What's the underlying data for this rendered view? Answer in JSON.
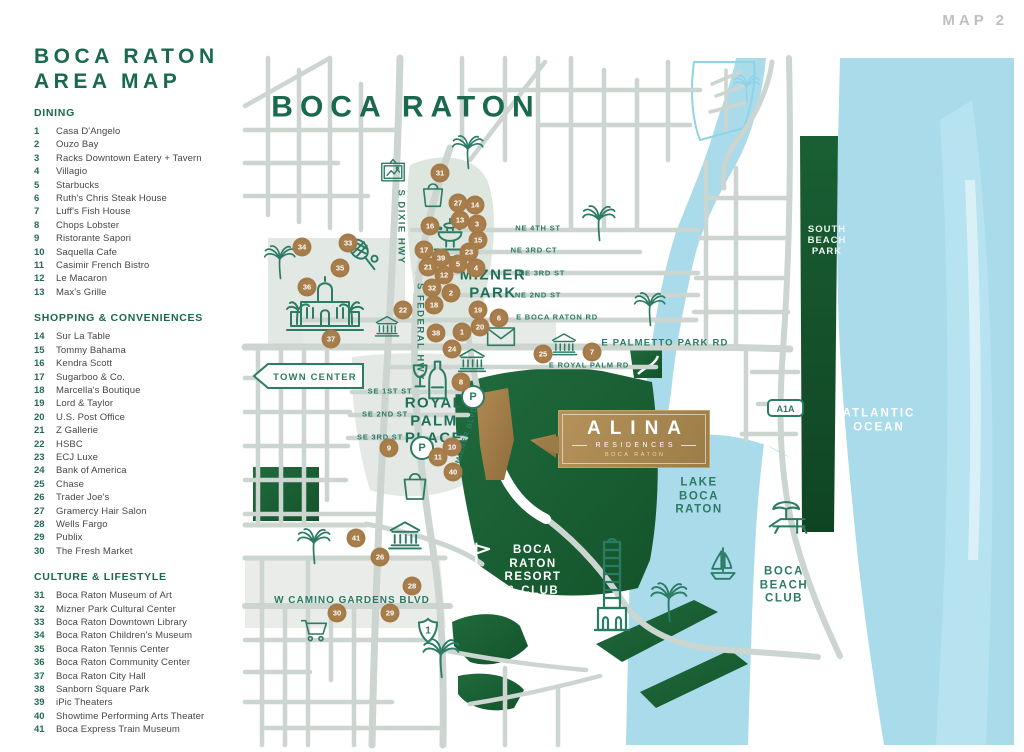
{
  "header": {
    "map_tag": "MAP 2"
  },
  "sidebar": {
    "title": "BOCA RATON\nAREA MAP",
    "sections": [
      {
        "title": "DINING",
        "items": [
          [
            "1",
            "Casa D'Angelo"
          ],
          [
            "2",
            "Ouzo Bay"
          ],
          [
            "3",
            "Racks Downtown Eatery + Tavern"
          ],
          [
            "4",
            "Villagio"
          ],
          [
            "5",
            "Starbucks"
          ],
          [
            "6",
            "Ruth's Chris Steak House"
          ],
          [
            "7",
            "Luff's Fish House"
          ],
          [
            "8",
            "Chops Lobster"
          ],
          [
            "9",
            "Ristorante Sapori"
          ],
          [
            "10",
            "Saquella Cafe"
          ],
          [
            "11",
            "Casimir French Bistro"
          ],
          [
            "12",
            "Le Macaron"
          ],
          [
            "13",
            "Max's Grille"
          ]
        ]
      },
      {
        "title": "SHOPPING & CONVENIENCES",
        "items": [
          [
            "14",
            "Sur La Table"
          ],
          [
            "15",
            "Tommy Bahama"
          ],
          [
            "16",
            "Kendra Scott"
          ],
          [
            "17",
            "Sugarboo & Co."
          ],
          [
            "18",
            "Marcella's Boutique"
          ],
          [
            "19",
            "Lord & Taylor"
          ],
          [
            "20",
            "U.S. Post Office"
          ],
          [
            "21",
            "Z Gallerie"
          ],
          [
            "22",
            "HSBC"
          ],
          [
            "23",
            "ECJ Luxe"
          ],
          [
            "24",
            "Bank of America"
          ],
          [
            "25",
            "Chase"
          ],
          [
            "26",
            "Trader Joe's"
          ],
          [
            "27",
            "Gramercy Hair Salon"
          ],
          [
            "28",
            "Wells Fargo"
          ],
          [
            "29",
            "Publix"
          ],
          [
            "30",
            "The Fresh Market"
          ]
        ]
      },
      {
        "title": "CULTURE & LIFESTYLE",
        "items": [
          [
            "31",
            "Boca Raton Museum of Art"
          ],
          [
            "32",
            "Mizner Park Cultural Center"
          ],
          [
            "33",
            "Boca Raton Downtown Library"
          ],
          [
            "34",
            "Boca Raton Children's Museum"
          ],
          [
            "35",
            "Boca Raton Tennis Center"
          ],
          [
            "36",
            "Boca Raton Community Center"
          ],
          [
            "37",
            "Boca Raton City Hall"
          ],
          [
            "38",
            "Sanborn Square Park"
          ],
          [
            "39",
            "iPic Theaters"
          ],
          [
            "40",
            "Showtime Performing Arts Theater"
          ],
          [
            "41",
            "Boca Express Train Museum"
          ]
        ]
      }
    ]
  },
  "map": {
    "signs": {
      "town_center": "TOWN CENTER",
      "a1a": "A1A",
      "us_route": "1",
      "parking": "P"
    },
    "alina": {
      "line1": "ALINA",
      "line2": "RESIDENCES",
      "line3": "BOCA RATON"
    },
    "colors": {
      "teal": "#2c7b64",
      "dark_green_title": "#19694f",
      "marker_bronze": "#a87e4c",
      "gold": "#a98a54",
      "water": "#a9dcec",
      "park": "#1e6b3d",
      "road": "#ccd5d0"
    },
    "area_labels": [
      {
        "t": "BOCA RATON",
        "x": 406,
        "y": 107,
        "s": 30,
        "ls": 7,
        "c": "#19694f"
      },
      {
        "t": "MIZNER\nPARK",
        "x": 493,
        "y": 284,
        "s": 15,
        "ls": 1.5,
        "c": "#1f6f58"
      },
      {
        "t": "ROYAL\nPALM\nPLACE",
        "x": 434,
        "y": 421,
        "s": 15,
        "ls": 1.5,
        "c": "#1f6f58"
      },
      {
        "t": "BOCA\nRATON\nRESORT\n& CLUB",
        "x": 533,
        "y": 571,
        "s": 11.5,
        "ls": 1.5,
        "c": "#ffffff"
      },
      {
        "t": "SOUTH\nBEACH\nPARK",
        "x": 827,
        "y": 241,
        "s": 9.5,
        "ls": 1,
        "c": "#eef6f1"
      },
      {
        "t": "ATLANTIC\nOCEAN",
        "x": 879,
        "y": 421,
        "s": 11.5,
        "ls": 2,
        "c": "#ffffff"
      },
      {
        "t": "LAKE\nBOCA\nRATON",
        "x": 699,
        "y": 497,
        "s": 11.5,
        "ls": 1.5,
        "c": "#2c7b64"
      },
      {
        "t": "BOCA\nBEACH\nCLUB",
        "x": 784,
        "y": 586,
        "s": 11.5,
        "ls": 1.5,
        "c": "#2c7b64"
      }
    ],
    "street_labels": [
      {
        "t": "NE 4TH ST",
        "x": 538,
        "y": 229
      },
      {
        "t": "NE 3RD CT",
        "x": 534,
        "y": 251
      },
      {
        "t": "NE 3RD ST",
        "x": 542,
        "y": 274
      },
      {
        "t": "NE 2ND ST",
        "x": 538,
        "y": 296
      },
      {
        "t": "E BOCA RATON RD",
        "x": 557,
        "y": 318
      },
      {
        "t": "E PALMETTO PARK RD",
        "x": 665,
        "y": 343,
        "s": 9.5,
        "ls": 1.2
      },
      {
        "t": "E ROYAL PALM RD",
        "x": 589,
        "y": 366
      },
      {
        "t": "SE 1ST ST",
        "x": 390,
        "y": 392
      },
      {
        "t": "SE 2ND ST",
        "x": 385,
        "y": 415
      },
      {
        "t": "SE 3RD ST",
        "x": 380,
        "y": 438
      },
      {
        "t": "W CAMINO GARDENS BLVD",
        "x": 352,
        "y": 601,
        "s": 10,
        "ls": 1
      },
      {
        "t": "S DIXIE HWY",
        "x": 401,
        "y": 227,
        "r": 90,
        "s": 9.5,
        "ls": 1.5
      },
      {
        "t": "S FEDERAL HWY",
        "x": 420,
        "y": 332,
        "r": 90,
        "s": 9.5,
        "ls": 1.5
      },
      {
        "t": "SE MIZNER BLVD",
        "x": 465,
        "y": 442,
        "r": -73,
        "s": 7.5
      }
    ],
    "markers": [
      {
        "n": "1",
        "x": 462,
        "y": 332
      },
      {
        "n": "2",
        "x": 451,
        "y": 293
      },
      {
        "n": "3",
        "x": 477,
        "y": 224
      },
      {
        "n": "4",
        "x": 476,
        "y": 268
      },
      {
        "n": "5",
        "x": 458,
        "y": 264
      },
      {
        "n": "6",
        "x": 499,
        "y": 318
      },
      {
        "n": "7",
        "x": 592,
        "y": 352
      },
      {
        "n": "8",
        "x": 461,
        "y": 382
      },
      {
        "n": "9",
        "x": 389,
        "y": 448
      },
      {
        "n": "10",
        "x": 452,
        "y": 447
      },
      {
        "n": "11",
        "x": 438,
        "y": 457
      },
      {
        "n": "12",
        "x": 444,
        "y": 275
      },
      {
        "n": "13",
        "x": 460,
        "y": 220
      },
      {
        "n": "14",
        "x": 475,
        "y": 205
      },
      {
        "n": "15",
        "x": 478,
        "y": 240
      },
      {
        "n": "16",
        "x": 430,
        "y": 226
      },
      {
        "n": "17",
        "x": 424,
        "y": 250
      },
      {
        "n": "18",
        "x": 434,
        "y": 305
      },
      {
        "n": "19",
        "x": 478,
        "y": 310
      },
      {
        "n": "20",
        "x": 480,
        "y": 327
      },
      {
        "n": "21",
        "x": 428,
        "y": 267
      },
      {
        "n": "22",
        "x": 403,
        "y": 310
      },
      {
        "n": "23",
        "x": 469,
        "y": 252
      },
      {
        "n": "24",
        "x": 452,
        "y": 349
      },
      {
        "n": "25",
        "x": 543,
        "y": 354
      },
      {
        "n": "26",
        "x": 380,
        "y": 557
      },
      {
        "n": "27",
        "x": 458,
        "y": 203
      },
      {
        "n": "28",
        "x": 412,
        "y": 586
      },
      {
        "n": "29",
        "x": 390,
        "y": 613
      },
      {
        "n": "30",
        "x": 337,
        "y": 613
      },
      {
        "n": "31",
        "x": 440,
        "y": 173
      },
      {
        "n": "32",
        "x": 432,
        "y": 288
      },
      {
        "n": "33",
        "x": 348,
        "y": 243
      },
      {
        "n": "34",
        "x": 302,
        "y": 247
      },
      {
        "n": "35",
        "x": 340,
        "y": 268
      },
      {
        "n": "36",
        "x": 307,
        "y": 287
      },
      {
        "n": "37",
        "x": 331,
        "y": 339
      },
      {
        "n": "38",
        "x": 436,
        "y": 333
      },
      {
        "n": "39",
        "x": 441,
        "y": 258
      },
      {
        "n": "40",
        "x": 453,
        "y": 472
      },
      {
        "n": "41",
        "x": 356,
        "y": 538
      }
    ],
    "icons": [
      {
        "k": "palm",
        "x": 279,
        "y": 262,
        "s": 36
      },
      {
        "k": "palm",
        "x": 467,
        "y": 152,
        "s": 36
      },
      {
        "k": "palm",
        "x": 598,
        "y": 223,
        "s": 38
      },
      {
        "k": "palm",
        "x": 649,
        "y": 309,
        "s": 36
      },
      {
        "k": "palm",
        "x": 313,
        "y": 546,
        "s": 38
      },
      {
        "k": "palm",
        "x": 440,
        "y": 658,
        "s": 42
      },
      {
        "k": "palm",
        "x": 668,
        "y": 602,
        "s": 42
      },
      {
        "k": "palm",
        "x": 746,
        "y": 89,
        "s": 30,
        "c": "#8fd2e5"
      },
      {
        "k": "frame",
        "x": 393,
        "y": 172,
        "s": 30
      },
      {
        "k": "bag",
        "x": 433,
        "y": 193,
        "s": 32
      },
      {
        "k": "bag",
        "x": 415,
        "y": 484,
        "s": 36
      },
      {
        "k": "fountain",
        "x": 450,
        "y": 238,
        "s": 46
      },
      {
        "k": "tennis",
        "x": 364,
        "y": 257,
        "s": 42
      },
      {
        "k": "cityhall",
        "x": 325,
        "y": 303,
        "w": 80,
        "h": 58
      },
      {
        "k": "bank",
        "x": 387,
        "y": 326,
        "s": 28
      },
      {
        "k": "bank",
        "x": 564,
        "y": 344,
        "s": 30
      },
      {
        "k": "bank",
        "x": 472,
        "y": 360,
        "s": 32
      },
      {
        "k": "bank",
        "x": 405,
        "y": 535,
        "s": 38
      },
      {
        "k": "envelope",
        "x": 501,
        "y": 336,
        "s": 32
      },
      {
        "k": "wine",
        "x": 432,
        "y": 380,
        "s": 44
      },
      {
        "k": "parking",
        "x": 473,
        "y": 397
      },
      {
        "k": "parking",
        "x": 422,
        "y": 448
      },
      {
        "k": "cart",
        "x": 315,
        "y": 630,
        "s": 32
      },
      {
        "k": "golf",
        "x": 480,
        "y": 560,
        "s": 44,
        "c": "#ffffff"
      },
      {
        "k": "tower",
        "x": 612,
        "y": 590,
        "w": 40,
        "h": 105
      },
      {
        "k": "sailboat",
        "x": 723,
        "y": 563,
        "s": 40
      },
      {
        "k": "beachchair",
        "x": 788,
        "y": 520,
        "s": 44
      }
    ]
  }
}
